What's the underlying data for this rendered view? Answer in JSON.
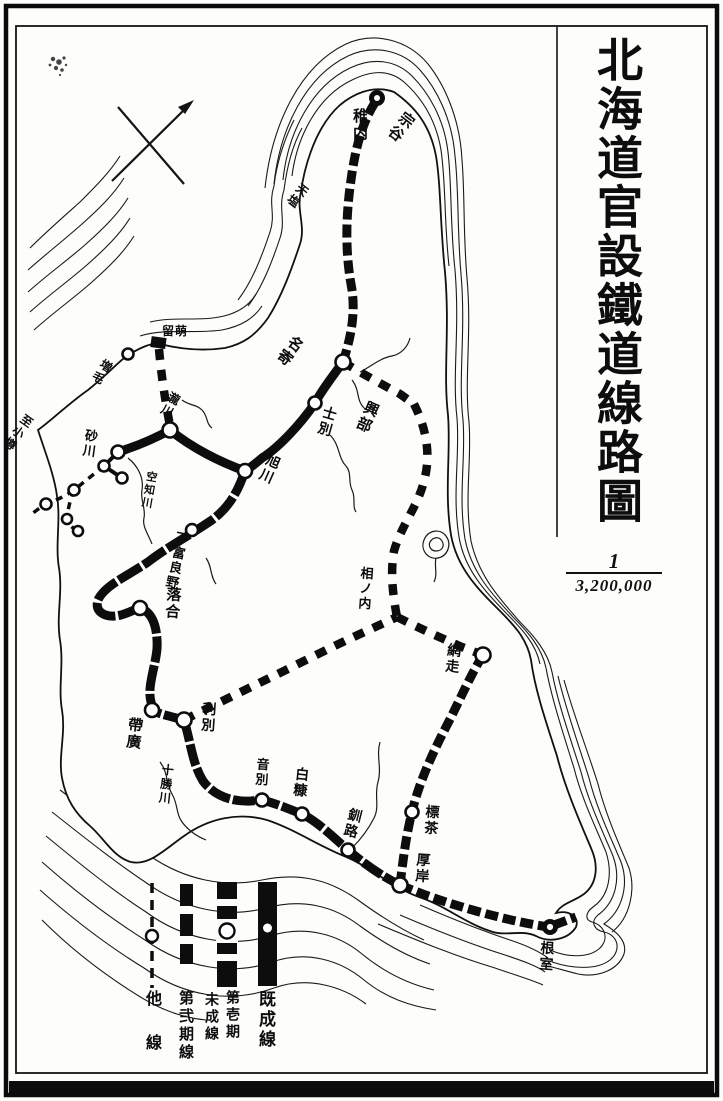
{
  "title": "北海道官設鐵道線路圖",
  "scale": {
    "numerator": "1",
    "denominator": "3,200,000"
  },
  "legend": {
    "items": [
      {
        "id": "kisei",
        "label": "既成線",
        "symbol": "thick-solid-bar-with-station-dot"
      },
      {
        "id": "dai1ki",
        "label": "第壱期未成線",
        "label_columns": [
          "第壱期",
          "未成線"
        ],
        "symbol": "thick-bar-with-gaps-and-circle"
      },
      {
        "id": "dai2ki",
        "label": "第弐期線",
        "symbol": "segmented-dashed-bar"
      },
      {
        "id": "tasen",
        "label": "他線",
        "symbol": "thin-dashed-line-with-circle"
      }
    ]
  },
  "map": {
    "labels": [
      {
        "id": "wakkanai",
        "text": "稚内",
        "x": 351,
        "y": 108,
        "rot": 0,
        "dir": "v",
        "fs": 15
      },
      {
        "id": "soya",
        "text": "宗谷",
        "x": 404,
        "y": 108,
        "rot": 38,
        "dir": "v",
        "fs": 15
      },
      {
        "id": "teshio",
        "text": "天塩",
        "x": 301,
        "y": 181,
        "rot": 38,
        "dir": "v",
        "fs": 12
      },
      {
        "id": "nayoro",
        "text": "名寄",
        "x": 293,
        "y": 332,
        "rot": 38,
        "dir": "v",
        "fs": 15
      },
      {
        "id": "okoppe",
        "text": "興部",
        "x": 366,
        "y": 398,
        "rot": 24,
        "dir": "v",
        "fs": 15
      },
      {
        "id": "shibetsu",
        "text": "士別",
        "x": 323,
        "y": 404,
        "rot": 16,
        "dir": "v",
        "fs": 14
      },
      {
        "id": "asahikawa",
        "text": "旭川",
        "x": 268,
        "y": 451,
        "rot": 24,
        "dir": "v",
        "fs": 14
      },
      {
        "id": "rumoi",
        "text": "留萌",
        "x": 162,
        "y": 325,
        "rot": 0,
        "dir": "h",
        "fs": 12
      },
      {
        "id": "mashike",
        "text": "増毛",
        "x": 104,
        "y": 357,
        "rot": 33,
        "dir": "v",
        "fs": 12
      },
      {
        "id": "takikawa",
        "text": "瀧川",
        "x": 171,
        "y": 390,
        "rot": 28,
        "dir": "v",
        "fs": 12
      },
      {
        "id": "sunagawa",
        "text": "砂川",
        "x": 85,
        "y": 428,
        "rot": 8,
        "dir": "v",
        "fs": 13
      },
      {
        "id": "otaru-link",
        "text": "至小樽",
        "x": 25,
        "y": 412,
        "rot": 36,
        "dir": "v",
        "fs": 12
      },
      {
        "id": "sorachigawa",
        "text": "空知川",
        "x": 146,
        "y": 470,
        "rot": 10,
        "dir": "v",
        "fs": 11
      },
      {
        "id": "shimofurano",
        "text": "下富良野",
        "x": 176,
        "y": 530,
        "rot": 12,
        "dir": "v",
        "fs": 13
      },
      {
        "id": "ochiai",
        "text": "落合",
        "x": 165,
        "y": 586,
        "rot": 4,
        "dir": "v",
        "fs": 15
      },
      {
        "id": "obihiro",
        "text": "帶廣",
        "x": 127,
        "y": 716,
        "rot": 6,
        "dir": "v",
        "fs": 15
      },
      {
        "id": "toshibetsu",
        "text": "利別",
        "x": 201,
        "y": 701,
        "rot": 4,
        "dir": "v",
        "fs": 14
      },
      {
        "id": "tokachigawa",
        "text": "十勝川",
        "x": 162,
        "y": 763,
        "rot": 6,
        "dir": "v",
        "fs": 12
      },
      {
        "id": "onbetsu",
        "text": "音別",
        "x": 256,
        "y": 757,
        "rot": 4,
        "dir": "v",
        "fs": 13
      },
      {
        "id": "shiranuka",
        "text": "白糠",
        "x": 294,
        "y": 766,
        "rot": 6,
        "dir": "v",
        "fs": 14
      },
      {
        "id": "kushiro",
        "text": "釧路",
        "x": 348,
        "y": 806,
        "rot": 14,
        "dir": "v",
        "fs": 14
      },
      {
        "id": "shibecha",
        "text": "標茶",
        "x": 424,
        "y": 804,
        "rot": 4,
        "dir": "v",
        "fs": 14
      },
      {
        "id": "akkeshi",
        "text": "厚岸",
        "x": 415,
        "y": 852,
        "rot": 4,
        "dir": "v",
        "fs": 14
      },
      {
        "id": "nemuro",
        "text": "根室",
        "x": 539,
        "y": 940,
        "rot": 4,
        "dir": "v",
        "fs": 14
      },
      {
        "id": "ainonai",
        "text": "相ノ内",
        "x": 360,
        "y": 566,
        "rot": 4,
        "dir": "v",
        "fs": 13
      },
      {
        "id": "abashiri",
        "text": "網走",
        "x": 446,
        "y": 642,
        "rot": 6,
        "dir": "v",
        "fs": 14
      }
    ]
  }
}
